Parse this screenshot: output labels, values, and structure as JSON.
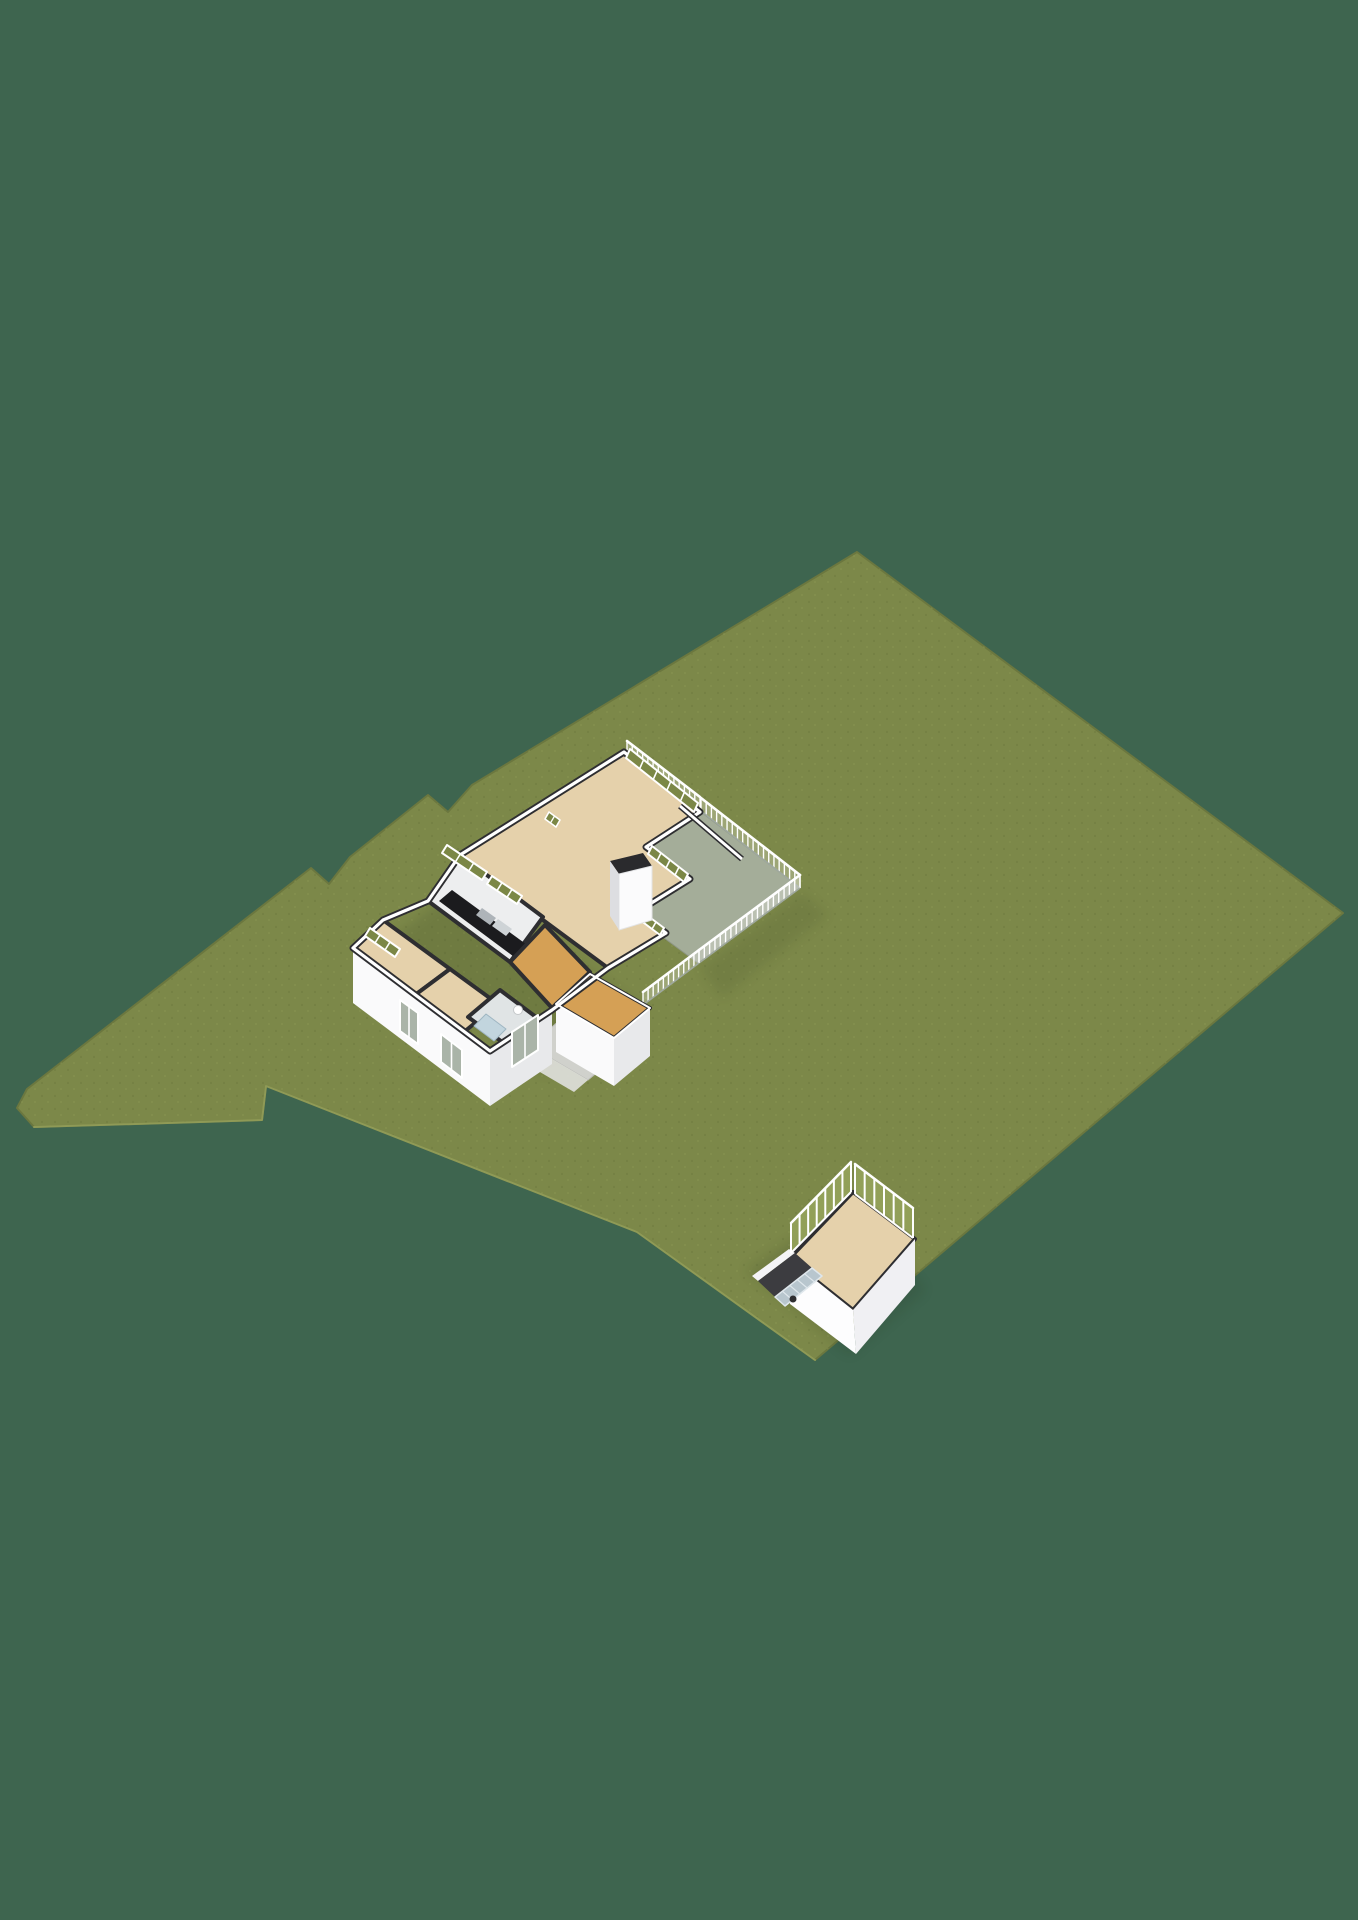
{
  "scene": {
    "width": 1358,
    "height": 1920,
    "background": "#3E654F",
    "colors": {
      "grass": "#7C8849",
      "grass_edge": "#6B773F",
      "grass_rim": "#98A35C",
      "wall_top_dark": "#2E2E31",
      "wall_white": "#FFFFFF",
      "facade_light": "#FAFAFB",
      "facade_shade": "#E8E9EB",
      "floor_tan": "#E5D1AB",
      "floor_orange": "#D5A055",
      "floor_terrace": "#A4AD99",
      "floor_bath": "#E0E4E5",
      "shower_blue": "#C2D5DE",
      "kitchen_counter": "#1B1B1E",
      "path_grey": "#D0D1CC",
      "glass_green": "#7B8746",
      "steps_blue": "#B8C6CE"
    },
    "items": [
      {
        "name": "ground-plot-grass",
        "type": "polygon",
        "points": "857,552 1343,913 815,1360 637,1232 266,1086 262,1120 200,1122 34,1127 17,1108 27,1089 311,868 329,884 350,857 428,795 448,812 472,785",
        "fill": "#7C8849",
        "stroke": "#6B773F",
        "sw": 2
      },
      {
        "name": "grass-texture",
        "type": "polygon",
        "points": "857,552 1343,913 815,1360 637,1232 266,1086 262,1120 200,1122 34,1127 17,1108 27,1089 311,868 329,884 350,857 428,795 448,812 472,785",
        "fill": "url(#grasstex)",
        "opacity": 0.5
      },
      {
        "name": "plot-sunlit-rim",
        "type": "polyline",
        "points": "34,1127 200,1122 262,1120 266,1086 637,1232 815,1360",
        "stroke": "#98A35C",
        "sw": 2,
        "opacity": 0.8
      },
      {
        "name": "house-shadow",
        "type": "polygon",
        "points": "375,950 545,1075 645,1012 470,880",
        "fill": "#15200F",
        "opacity": 0.12,
        "filter": "soft"
      },
      {
        "name": "terrace-shadow",
        "type": "polygon",
        "points": "700,968 802,892 828,915 722,998",
        "fill": "#15200F",
        "opacity": 0.09,
        "filter": "soft"
      },
      {
        "name": "terrace-floor",
        "type": "polygon",
        "points": "627,757 701,812 800,888 698,963 610,898 610,812",
        "fill": "#A4AD99",
        "stroke": "#8F9787",
        "sw": 1
      },
      {
        "name": "terrace-railing-ne-strip",
        "type": "railing",
        "x1": 627,
        "y1": 754,
        "x2": 700,
        "y2": 810,
        "h": 13,
        "step": 6.5,
        "fill": "#FFFFFF",
        "fillOpacity": 0.25,
        "psw": 1.4,
        "rsw": 2.6,
        "base": "#9FA89E",
        "bsw": 1.6
      },
      {
        "name": "terrace-railing-ne",
        "type": "railing",
        "x1": 701,
        "y1": 811,
        "x2": 800,
        "y2": 888,
        "h": 13,
        "step": 6.5,
        "fill": "#FFFFFF",
        "fillOpacity": 0.25,
        "psw": 1.4,
        "rsw": 2.6,
        "base": "#9FA89E",
        "bsw": 1.6
      },
      {
        "name": "terrace-railing-se",
        "type": "railing",
        "x1": 800,
        "y1": 888,
        "x2": 699,
        "y2": 963,
        "h": 13,
        "step": 6.5,
        "fill": "#FFFFFF",
        "fillOpacity": 0.25,
        "psw": 1.4,
        "rsw": 2.6,
        "base": "#9FA89E",
        "bsw": 1.6
      },
      {
        "name": "terrace-railing-sw",
        "type": "railing",
        "x1": 699,
        "y1": 963,
        "x2": 643,
        "y2": 1005,
        "h": 13,
        "step": 6.5,
        "fill": "#FFFFFF",
        "fillOpacity": 0.25,
        "psw": 1.4,
        "rsw": 2.6,
        "base": "#9FA89E",
        "bsw": 1.6
      },
      {
        "name": "living-room-floor",
        "type": "polygon",
        "points": "624,752 700,812 646,847 690,879 637,912 666,933 608,968 543,920 460,855",
        "fill": "#E5D1AB",
        "stroke": "#2E2E31",
        "sw": 4
      },
      {
        "name": "kitchen-floor",
        "type": "polygon",
        "points": "460,855 543,917 510,962 428,901",
        "fill": "#EDEEEF",
        "stroke": "#2E2E31",
        "sw": 4
      },
      {
        "name": "kitchen-counter",
        "type": "polygon",
        "points": "452,890 534,950 521,962 439,901",
        "fill": "#1B1B1E"
      },
      {
        "name": "kitchen-sink",
        "type": "polygon",
        "points": "482,908 496,918 490,925 476,915",
        "fill": "#AEB4B9"
      },
      {
        "name": "kitchen-cooktop",
        "type": "polygon",
        "points": "498,919 512,929 506,936 492,926",
        "fill": "#CED3D6"
      },
      {
        "name": "hallway-floor",
        "type": "polygon",
        "points": "510,962 545,925 590,972 552,1008",
        "fill": "#D5A055",
        "stroke": "#2E2E31",
        "sw": 4
      },
      {
        "name": "bedroom1-floor",
        "type": "polygon",
        "points": "383,920 450,969 415,995 353,948",
        "fill": "#E5D1AB",
        "stroke": "#2E2E31",
        "sw": 4
      },
      {
        "name": "bedroom2-floor",
        "type": "polygon",
        "points": "450,969 498,1004 464,1032 415,995",
        "fill": "#E5D1AB",
        "stroke": "#2E2E31",
        "sw": 4
      },
      {
        "name": "bathroom-floor",
        "type": "polygon",
        "points": "500,990 536,1017 505,1044 468,1017",
        "fill": "#E0E4E5",
        "stroke": "#2E2E31",
        "sw": 4
      },
      {
        "name": "shower-tray",
        "type": "polygon",
        "points": "486,1014 506,1029 494,1041 474,1026",
        "fill": "#C2D5DE",
        "stroke": "#9FB6C2",
        "sw": 1
      },
      {
        "name": "toilet",
        "type": "circle",
        "cx": 518,
        "cy": 1010,
        "r": 4.5,
        "fill": "#FFFFFF",
        "stroke": "#C5C8CA",
        "sw": 1
      },
      {
        "name": "storeroom-floor",
        "type": "polygon",
        "points": "590,974 650,1008 614,1038 556,1004",
        "fill": "#D5A055",
        "stroke": "#2E2E31",
        "sw": 4
      },
      {
        "name": "entrance-path",
        "type": "polygon",
        "points": "560,1020 618,1055 588,1080 530,1046",
        "fill": "#D0D1CC",
        "stroke": "#BBBCB7",
        "sw": 1
      },
      {
        "name": "entrance-path-lower",
        "type": "polygon",
        "points": "530,1046 588,1080 574,1092 516,1058",
        "fill": "#DBDCD7",
        "opacity": 0.95
      },
      {
        "name": "house-facade-sw",
        "type": "polygon",
        "points": "353,948 490,1051 490,1106 353,1003",
        "fill": "#FAFAFB"
      },
      {
        "name": "house-facade-se",
        "type": "polygon",
        "points": "490,1051 552,1010 552,1064 490,1106",
        "fill": "#E8E9EB"
      },
      {
        "name": "storeroom-facade-sw",
        "type": "polygon",
        "points": "556,1004 614,1038 614,1086 556,1052",
        "fill": "#FAFAFB"
      },
      {
        "name": "storeroom-facade-se",
        "type": "polygon",
        "points": "614,1038 650,1008 650,1056 614,1086",
        "fill": "#E8E9EB"
      },
      {
        "name": "outer-wall-dark",
        "type": "polyline",
        "points": "428,901 460,855 624,752 700,812 646,847 690,879 637,912 666,933 608,968 552,1010 490,1051 353,948 383,920 428,901",
        "stroke": "#2E2E31",
        "sw": 7
      },
      {
        "name": "outer-wall-white",
        "type": "polyline",
        "points": "428,901 460,855 624,752 700,812 646,847 690,879 637,912 666,933 608,968 552,1010 490,1051 353,948 383,920 428,901",
        "stroke": "#FFFFFF",
        "sw": 3.2
      },
      {
        "name": "storeroom-wall-white",
        "type": "polyline",
        "points": "556,1004 590,974 650,1008 614,1038 556,1004",
        "stroke": "#FFFFFF",
        "sw": 2
      },
      {
        "name": "terrace-divider-wall",
        "type": "line",
        "x1": 680,
        "y1": 806,
        "x2": 742,
        "y2": 859,
        "stroke": "#2E2E31",
        "sw": 6
      },
      {
        "name": "terrace-divider-wall-white",
        "type": "line",
        "x1": 680,
        "y1": 806,
        "x2": 742,
        "y2": 859,
        "stroke": "#FFFFFF",
        "sw": 2.8
      },
      {
        "name": "glass-door-ne",
        "type": "glass",
        "points": "630,749 698,803 694,812 626,758",
        "fill": "#7B8746",
        "stroke": "#FFFFFF",
        "sw": 2,
        "divs": 4
      },
      {
        "name": "glass-door-se-upper",
        "type": "glass",
        "points": "652,846 688,874 684,882 648,854",
        "fill": "#7B8746",
        "stroke": "#FFFFFF",
        "sw": 2,
        "divs": 3
      },
      {
        "name": "glass-door-se-lower",
        "type": "glass",
        "points": "640,910 664,928 660,935 636,917",
        "fill": "#7B8746",
        "stroke": "#FFFFFF",
        "sw": 2,
        "divs": 2
      },
      {
        "name": "window-kitchen-a",
        "type": "glass",
        "points": "447,845 487,872 482,880 442,853",
        "fill": "#7B8746",
        "stroke": "#FFFFFF",
        "sw": 2,
        "divs": 2
      },
      {
        "name": "window-kitchen-b",
        "type": "glass",
        "points": "492,876 522,896 517,904 487,884",
        "fill": "#7B8746",
        "stroke": "#FFFFFF",
        "sw": 2,
        "divs": 2
      },
      {
        "name": "window-living-narrow",
        "type": "glass",
        "points": "549,812 560,820 556,827 545,819",
        "fill": "#7B8746",
        "stroke": "#FFFFFF",
        "sw": 1.6,
        "divs": 1
      },
      {
        "name": "window-bedroom1",
        "type": "glass",
        "points": "370,928 400,949 395,957 365,936",
        "fill": "#7B8746",
        "stroke": "#FFFFFF",
        "sw": 2,
        "divs": 2
      },
      {
        "name": "window-facade-bedroom2",
        "type": "glass",
        "points": "441,1034 462,1050 462,1078 441,1062",
        "fill": "#AAB4A8",
        "stroke": "#FFFFFF",
        "sw": 2,
        "divs": 1
      },
      {
        "name": "window-facade-bathroom",
        "type": "glass",
        "points": "512,1032 538,1015 538,1050 512,1067",
        "fill": "#AAB4A8",
        "stroke": "#FFFFFF",
        "sw": 2,
        "divs": 1
      },
      {
        "name": "window-facade-west",
        "type": "glass",
        "points": "400,1000 418,1013 418,1044 400,1031",
        "fill": "#AAB4A8",
        "stroke": "#FFFFFF",
        "sw": 2,
        "divs": 1
      },
      {
        "name": "fireplace-top",
        "type": "polygon",
        "points": "610,861 643,853 652,866 619,874",
        "fill": "#2A2A2D"
      },
      {
        "name": "fireplace-front",
        "type": "polygon",
        "points": "619,874 652,866 652,920 619,930",
        "fill": "#FBFBFC",
        "stroke": "#E3E4E6",
        "sw": 1
      },
      {
        "name": "fireplace-side",
        "type": "polygon",
        "points": "610,861 619,874 619,930 610,916",
        "fill": "#DDDEE1"
      },
      {
        "name": "outbuilding-shadow",
        "type": "polygon",
        "points": "745,1270 850,1355 925,1290 855,1200",
        "fill": "#15200F",
        "opacity": 0.12,
        "filter": "soft"
      },
      {
        "name": "outbuilding-floor",
        "type": "polygon",
        "points": "853,1192 915,1239 853,1310 789,1259",
        "fill": "#E5D1AB",
        "stroke": "#2E2E31",
        "sw": 4
      },
      {
        "name": "outbuilding-facade-se",
        "type": "polygon",
        "points": "853,1310 915,1239 915,1285 856,1354",
        "fill": "#F0F0F3"
      },
      {
        "name": "outbuilding-facade-sw",
        "type": "polygon",
        "points": "789,1259 853,1310 856,1354 790,1304",
        "fill": "#FDFDFE"
      },
      {
        "name": "outbuilding-slope-edge",
        "type": "polygon",
        "points": "752,1276 789,1249 795,1253 758,1281",
        "fill": "#F4F4F6"
      },
      {
        "name": "outbuilding-slope-dark",
        "type": "polygon",
        "points": "758,1281 795,1253 812,1268 775,1297",
        "fill": "#3C3C40"
      },
      {
        "name": "outbuilding-cellar-steps",
        "type": "glass",
        "points": "775,1297 812,1268 822,1276 785,1306",
        "fill": "#B8C6CE",
        "stroke": "#DFE7EC",
        "sw": 1.5,
        "divs": 4
      },
      {
        "name": "outbuilding-step-object",
        "type": "circle",
        "cx": 793,
        "cy": 1299,
        "r": 3.5,
        "fill": "#2E2E31"
      },
      {
        "name": "outbuilding-mullions-nw",
        "type": "railing",
        "x1": 791,
        "y1": 1253,
        "x2": 851,
        "y2": 1192,
        "h": 30,
        "step": 12,
        "fill": "#96A55C",
        "fillOpacity": 0.85,
        "psw": 2,
        "rsw": 2.5,
        "base": "#FFFFFF",
        "bsw": 2
      },
      {
        "name": "outbuilding-mullions-ne",
        "type": "railing",
        "x1": 855,
        "y1": 1194,
        "x2": 913,
        "y2": 1238,
        "h": 30,
        "step": 12,
        "fill": "#96A55C",
        "fillOpacity": 0.85,
        "psw": 2,
        "rsw": 2.5,
        "base": "#FFFFFF",
        "bsw": 2
      }
    ]
  }
}
